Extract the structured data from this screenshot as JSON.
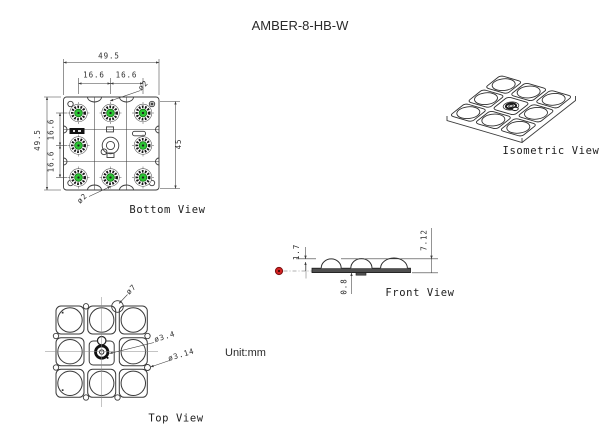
{
  "title": "AMBER-8-HB-W",
  "unit_note": "Unit:mm",
  "colors": {
    "line": "#3c3c3c",
    "led_green": "#2dc435",
    "red_marker": "#d42222",
    "pcb_fill": "#4f4f4f"
  },
  "views": {
    "bottom": {
      "label": "Bottom View",
      "dims": {
        "overall_width": "49.5",
        "col_pitch_left": "16.6",
        "col_pitch_right": "16.6",
        "overall_height": "49.5",
        "row_pitch_top": "16.6",
        "row_pitch_bottom": "16.6",
        "inner_height": "45",
        "hole_top": "ø2",
        "hole_bottom": "ø2"
      }
    },
    "isometric": {
      "label": "Isometric View"
    },
    "front": {
      "label": "Front View",
      "dims": {
        "lens_height": "1.7",
        "pcb_thickness": "0.8",
        "total_height": "7.12"
      }
    },
    "top": {
      "label": "Top View",
      "dims": {
        "lens_diameter": "ø7",
        "center_hole": "ø3.4",
        "edge_hole": "ø3.14"
      }
    }
  }
}
